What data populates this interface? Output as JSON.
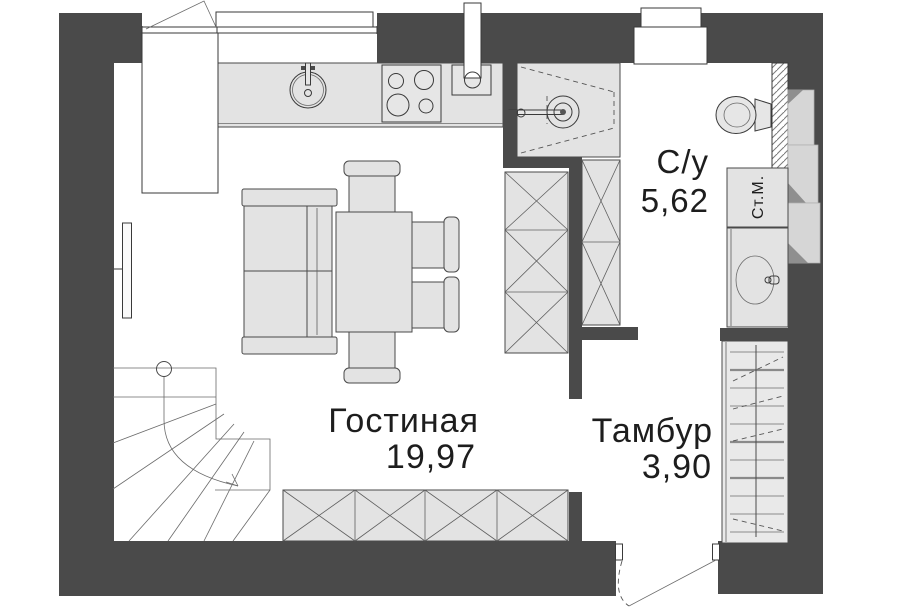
{
  "plan": {
    "rooms": {
      "living": {
        "name": "Гостиная",
        "area": "19,97"
      },
      "bathroom": {
        "name": "С/у",
        "area": "5,62"
      },
      "vestibule": {
        "name": "Тамбур",
        "area": "3,90"
      }
    },
    "appliances": {
      "washing_machine": "Ст.М."
    },
    "colors": {
      "wall": "#4a4a4a",
      "furniture": "#e3e3e3",
      "outline": "#3a3a3a",
      "text": "#1d1d1d",
      "stairs": "#e9e9e9",
      "step": "#d6d6d6",
      "step_shadow": "#8f8f8f",
      "background": "#ffffff"
    }
  }
}
